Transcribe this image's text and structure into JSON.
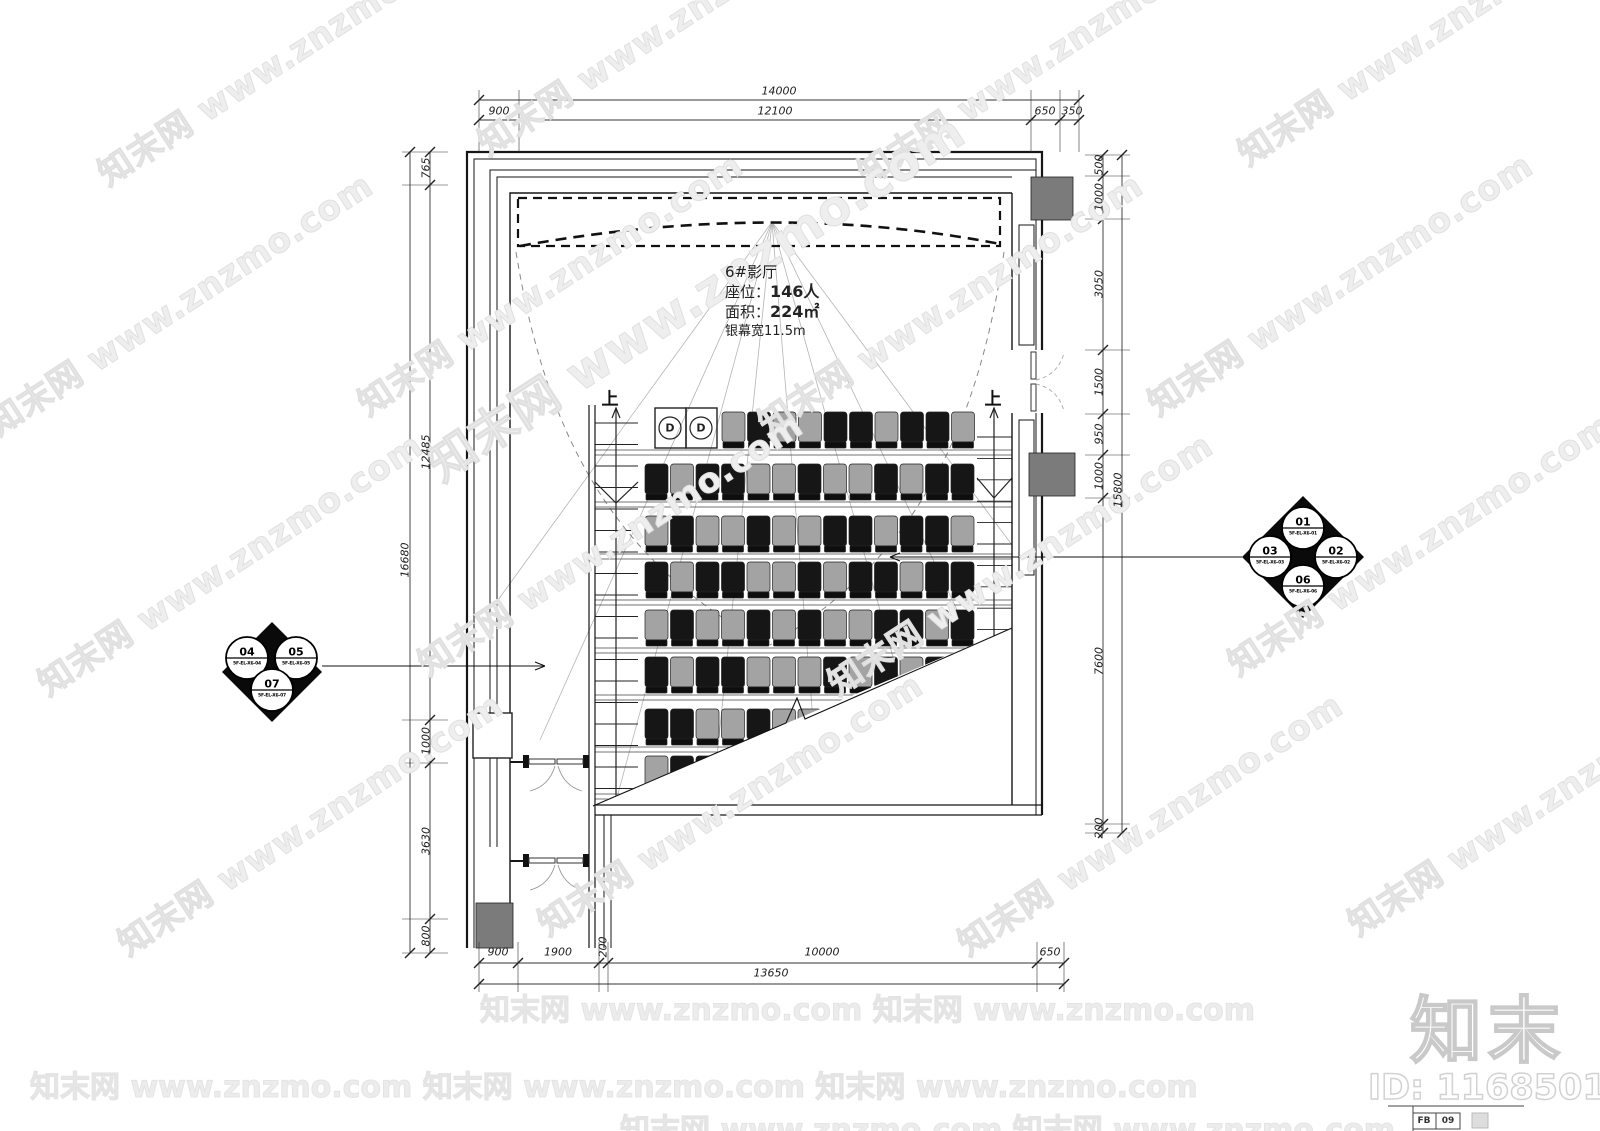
{
  "room_info": {
    "title": "6#影厅",
    "seats_label": "座位：",
    "seats_value": "146人",
    "area_label": "面积：",
    "area_value": "224㎡",
    "screen_label": "银幕宽",
    "screen_value": "11.5m"
  },
  "stairs": {
    "left_up": "上",
    "right_up": "上"
  },
  "accessible_seats_label": "D",
  "dimensions": {
    "top": {
      "overall": "14000",
      "segments": [
        "900",
        "12100",
        "650",
        "350"
      ]
    },
    "bottom": {
      "overall": "13650",
      "segments": [
        "900",
        "1900",
        "200",
        "10000",
        "650"
      ]
    },
    "left": {
      "overall": "16680",
      "segments": [
        "765",
        "12485",
        "1000",
        "3630",
        "800"
      ]
    },
    "right": {
      "overall": "15800",
      "segments": [
        "500",
        "1000",
        "3050",
        "1500",
        "950",
        "1000",
        "7600",
        "200"
      ]
    }
  },
  "callouts": {
    "right_cluster": [
      {
        "num": "01",
        "ref": "5F-EL-X6-01"
      },
      {
        "num": "02",
        "ref": "5F-EL-X6-02"
      },
      {
        "num": "03",
        "ref": "5F-EL-X6-03"
      },
      {
        "num": "06",
        "ref": "5F-EL-X6-06"
      }
    ],
    "left_cluster": [
      {
        "num": "04",
        "ref": "5F-EL-X6-04"
      },
      {
        "num": "05",
        "ref": "5F-EL-X6-05"
      },
      {
        "num": "07",
        "ref": "5F-EL-X6-07"
      }
    ]
  },
  "watermark": {
    "text": "知末网 www.znzmo.com"
  },
  "branding": {
    "logo": "知末",
    "id": "ID: 1168501527"
  },
  "titleblock": {
    "cell1": "FB",
    "cell2": "09"
  },
  "seating": {
    "dark_color": "#161616",
    "gray_color": "#a3a3a3",
    "back_color": "#0e0e0e",
    "rows": [
      {
        "y": 412,
        "x0": 722,
        "pattern": "gdggddgddg"
      },
      {
        "y": 464,
        "x0": 645,
        "pattern": "dgddggdggdgdd"
      },
      {
        "y": 516,
        "x0": 645,
        "pattern": "gdggdggddgddg"
      },
      {
        "y": 562,
        "x0": 645,
        "pattern": "dgddggdgddgdd"
      },
      {
        "y": 610,
        "x0": 645,
        "pattern": "gdggdgdggddgd"
      },
      {
        "y": 657,
        "x0": 645,
        "pattern": "dgddgggdgdgdd"
      },
      {
        "y": 709,
        "x0": 645,
        "pattern": "ddggdggddggdd"
      },
      {
        "y": 756,
        "x0": 645,
        "pattern": "gddggddgdggdd"
      }
    ]
  }
}
